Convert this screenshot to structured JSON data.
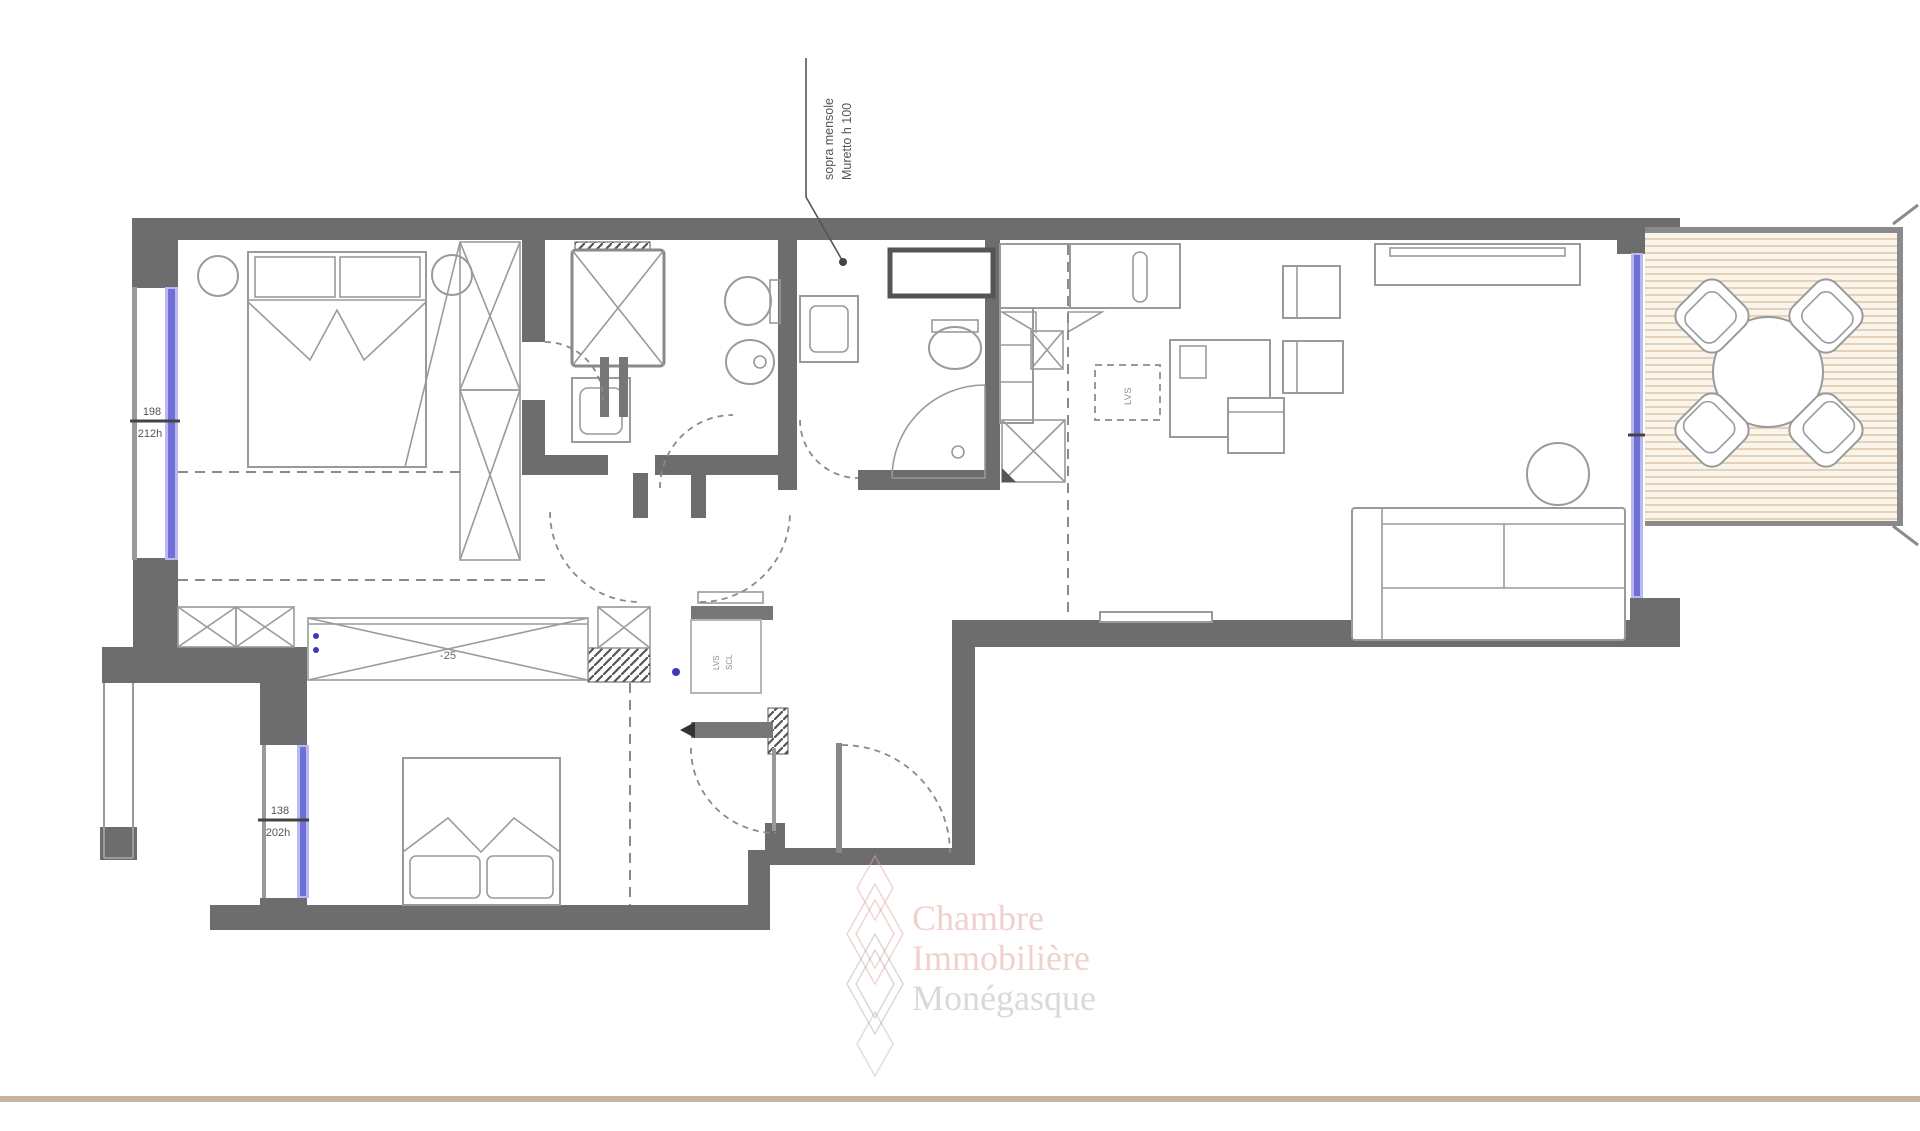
{
  "annotation": {
    "muretto_line1": "Muretto h 100",
    "muretto_line2": "sopra mensole"
  },
  "dimensions": {
    "bedroom1_window": {
      "width": "198",
      "height": "212h"
    },
    "bedroom2_window": {
      "width": "138",
      "height": "202h"
    },
    "living_window": {
      "width": "320",
      "height": "212h"
    }
  },
  "labels": {
    "wardrobe_level": "-25",
    "dishwasher": "LVS",
    "laundry_line1": "LVS",
    "laundry_line2": "SCL"
  },
  "watermark": {
    "line1": "Chambre",
    "line2": "Immobilière",
    "line3": "Monégasque"
  },
  "colors": {
    "wall": "#6d6d6d",
    "thin_wall": "#8a8a8a",
    "window_core": "#6f6fd8",
    "window_halo": "#b9b9ee",
    "deck_stripe": "#dcc29b",
    "deck_background": "#faf5ec",
    "watermark_pink": "#e2aca5",
    "baseline": "#c4b6a0",
    "furniture_line": "#9a9a9a"
  }
}
